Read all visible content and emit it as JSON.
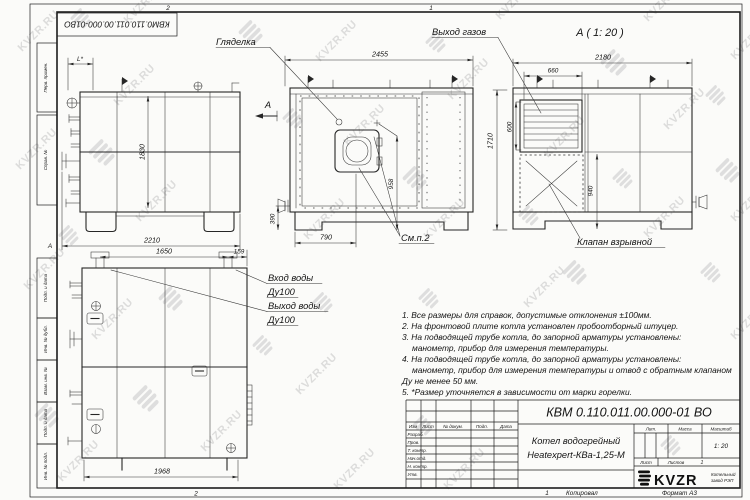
{
  "meta": {
    "watermark_text": "KVZR.RU"
  },
  "frame": {
    "doc_number_top": "КВМ0.110.011.00.000-01ВО",
    "zone_top_left": "2",
    "zone_top_right": "1",
    "zone_bottom": "2",
    "zone_left": "А",
    "side_labels": [
      "Перв. примен.",
      "Справ. №",
      "Подп. и дата",
      "Инв. № дубл.",
      "Взам. инв. №",
      "Подп. и дата",
      "Инв. № подл."
    ]
  },
  "labels": {
    "glyadelka": "Гляделка",
    "gas_outlet": "Выход газов",
    "view_a": "А ( 1: 20 )",
    "section_a": "А",
    "water_inlet": "Вход воды",
    "water_inlet_dn": "Ду100",
    "water_outlet": "Выход воды",
    "water_outlet_dn": "Ду100",
    "explosion_valve": "Клапан взрывной",
    "see_note": "См.п.2"
  },
  "dims": {
    "l_star": "L*",
    "h1830": "1830",
    "w2210": "2210",
    "w2455": "2455",
    "h958": "958",
    "h390": "390",
    "w790": "790",
    "h1710": "1710",
    "w2180": "2180",
    "w660": "660",
    "h600": "600",
    "h940": "940",
    "w1650": "1650",
    "w159": "159",
    "w1968": "1968"
  },
  "notes": {
    "lines": [
      "1. Все размеры для справок, допустимые отклонения ±100мм.",
      "2. На фронтовой плите котла установлен пробоотборный штуцер.",
      "3. На подводящей трубе котла, до запорной арматуры установлены:",
      "манометр, прибор для измерения температуры.",
      "4. На подводящей трубе котла, до запорной арматуры установлены:",
      "манометр, прибор для измерения температуры и отвод с обратным клапаном",
      "Ду не менее 50 мм.",
      "5. *Размер уточняется в зависимости от марки горелки."
    ]
  },
  "title_block": {
    "doc_number": "КВМ 0.110.011.00.000-01 ВО",
    "product_name_1": "Котел водогрейный",
    "product_name_2": "Heatexpert-КВа-1,25-М",
    "cols": {
      "izm": "Изм",
      "list": "Лист",
      "doc": "№ докум.",
      "podp": "Подп.",
      "data": "Дата"
    },
    "rows": [
      "Разраб.",
      "Пров.",
      "Т. контр.",
      "Нач.отд.",
      "Н. контр.",
      "Утв."
    ],
    "lit": "Лит.",
    "mass": "Масса",
    "scale": "Масштаб",
    "scale_value": "1: 20",
    "sheet": "Лист",
    "sheets": "Листов",
    "sheets_value": "1",
    "logo": "KVZR",
    "logo_sub1": "Котельный",
    "logo_sub2": "завод РЭП",
    "copy_num": "1",
    "copied": "Копировал",
    "format": "Формат А3"
  }
}
